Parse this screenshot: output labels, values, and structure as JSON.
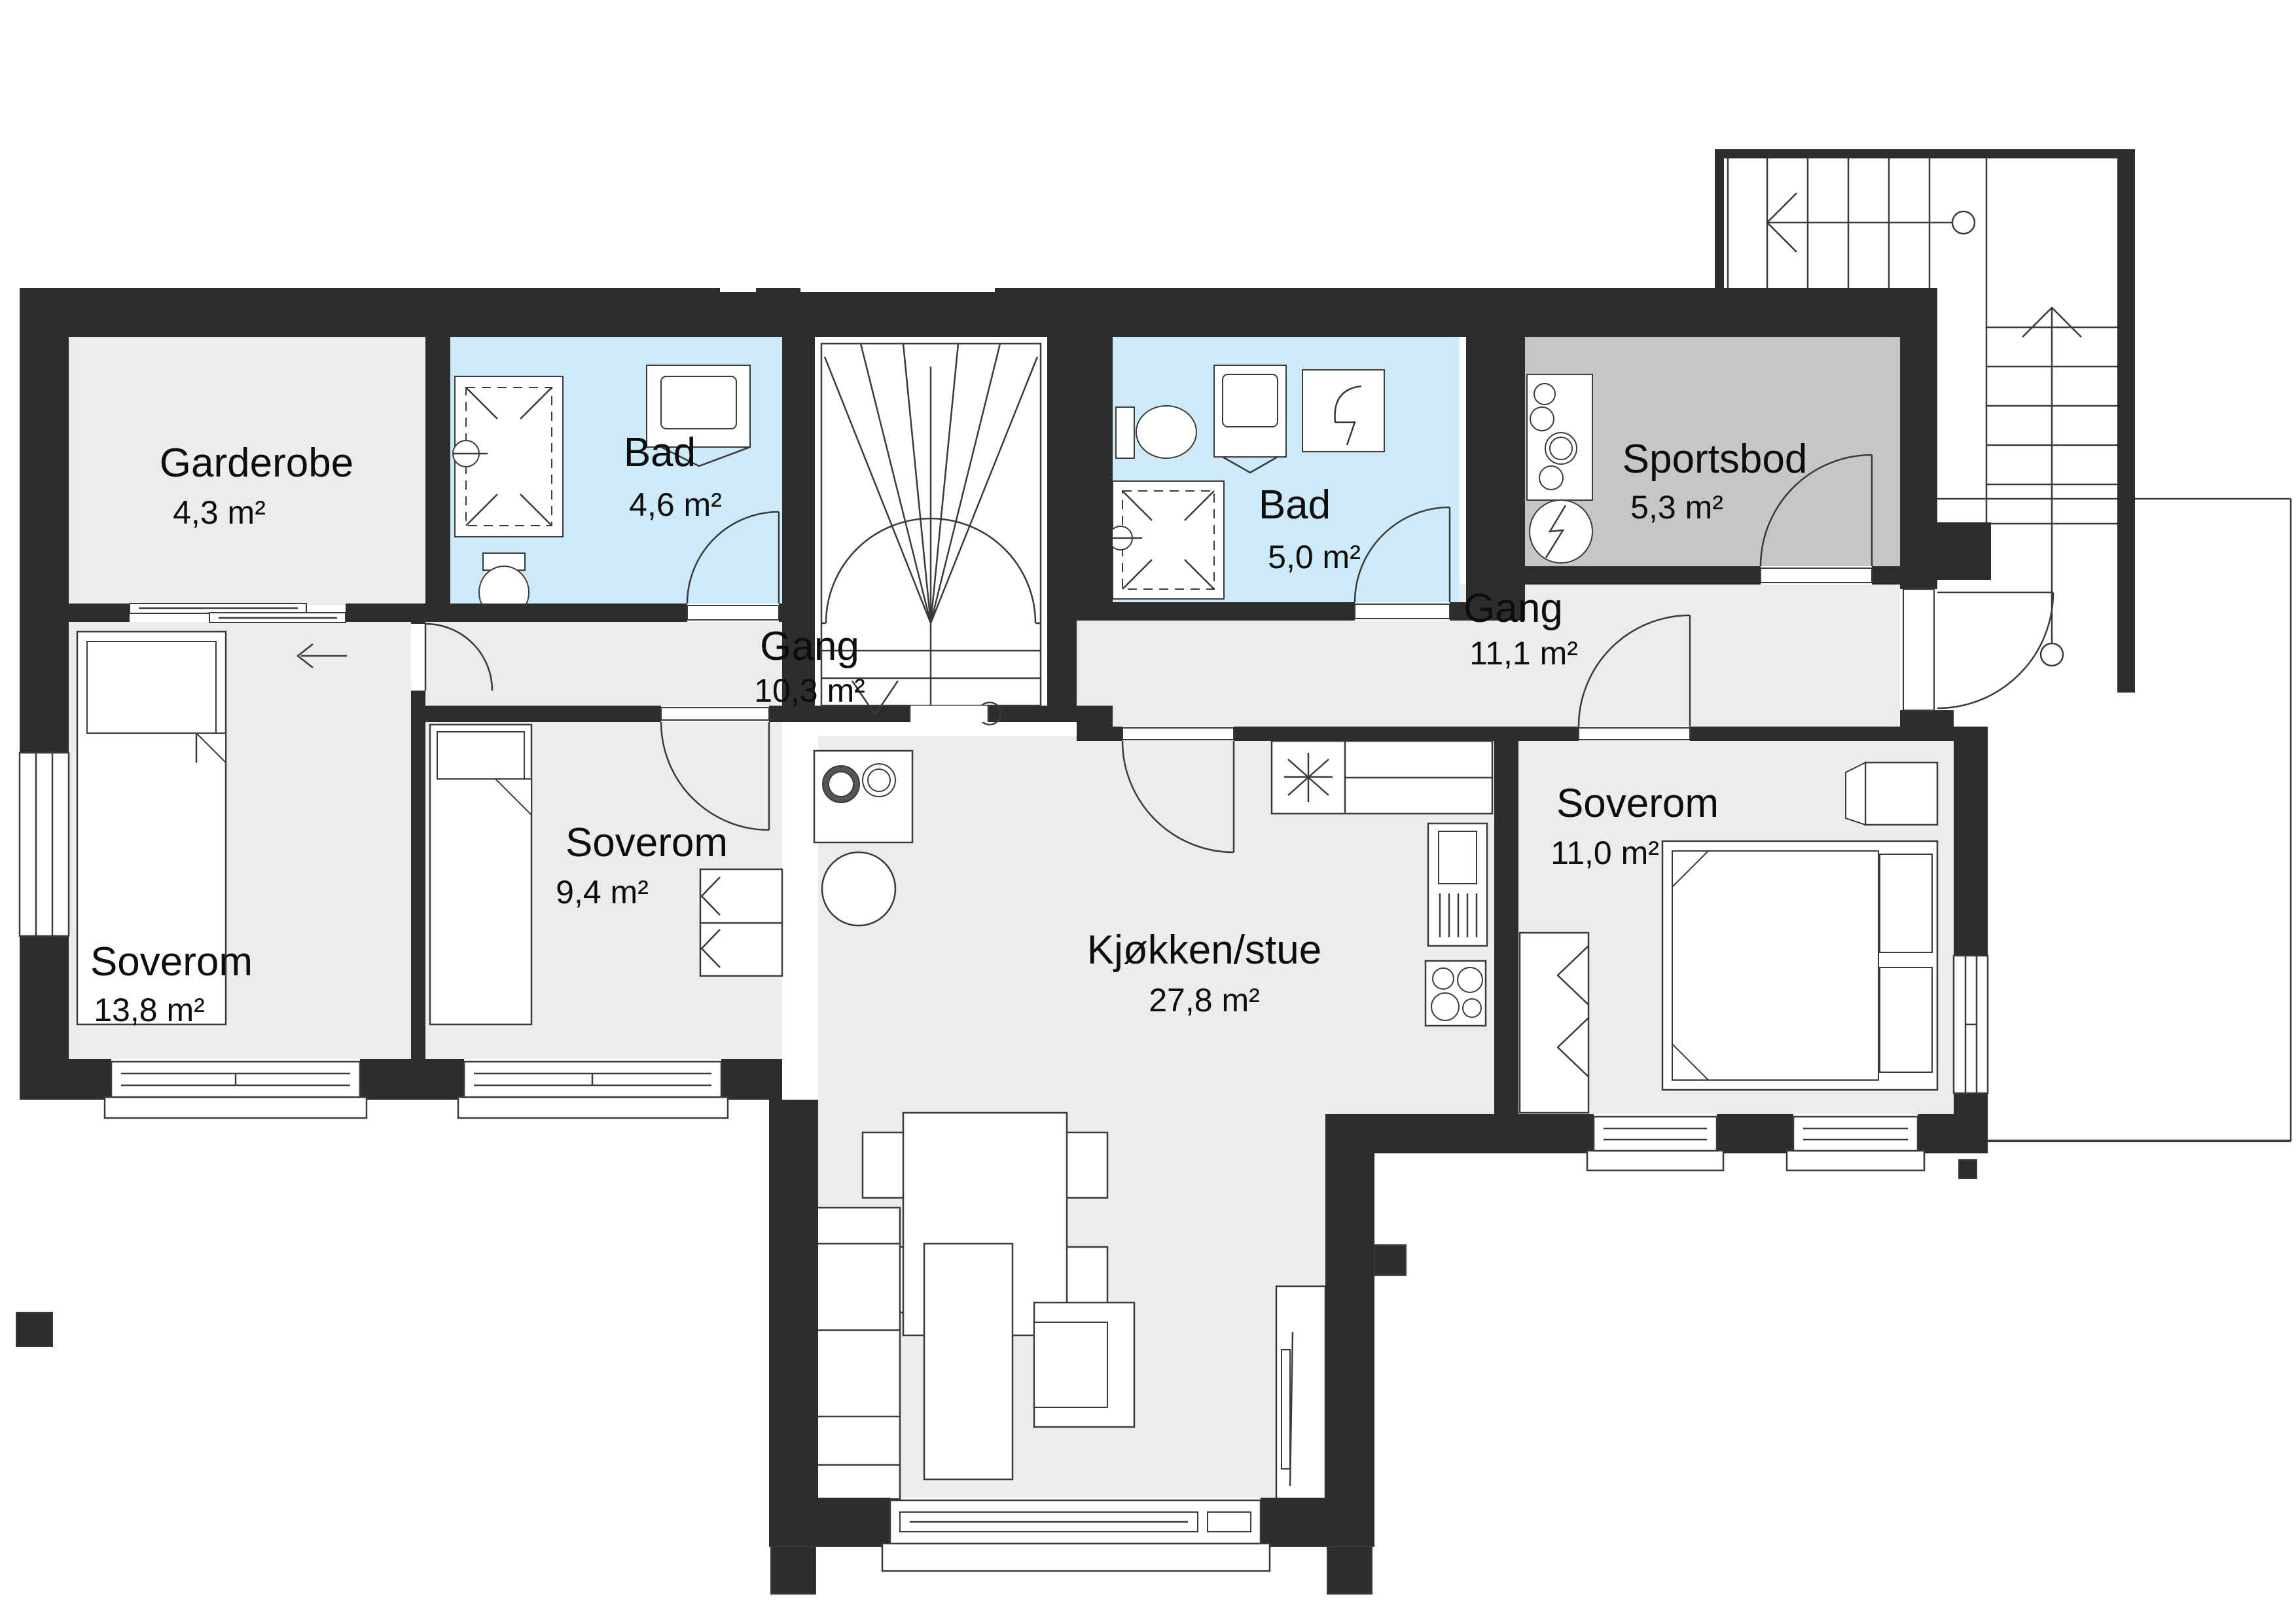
{
  "plan_title": "1. etasje plantegning",
  "colors": {
    "wall": "#2d2d2d",
    "floor": "#ececec",
    "wet": "#cdeaf8",
    "storage": "#c6c6c6",
    "stair": "#ffffff",
    "line": "#3a3a3a"
  },
  "rooms": [
    {
      "name": "Garderobe",
      "area": "4,3 m²"
    },
    {
      "name": "Bad",
      "area": "4,6 m²"
    },
    {
      "name": "Gang",
      "area": "10,3 m²"
    },
    {
      "name": "Bad",
      "area": "5,0 m²"
    },
    {
      "name": "Sportsbod",
      "area": "5,3 m²"
    },
    {
      "name": "Gang",
      "area": "11,1 m²"
    },
    {
      "name": "Soverom",
      "area": "13,8 m²"
    },
    {
      "name": "Soverom",
      "area": "9,4 m²"
    },
    {
      "name": "Kjøkken/stue",
      "area": "27,8 m²"
    },
    {
      "name": "Soverom",
      "area": "11,0 m²"
    }
  ]
}
